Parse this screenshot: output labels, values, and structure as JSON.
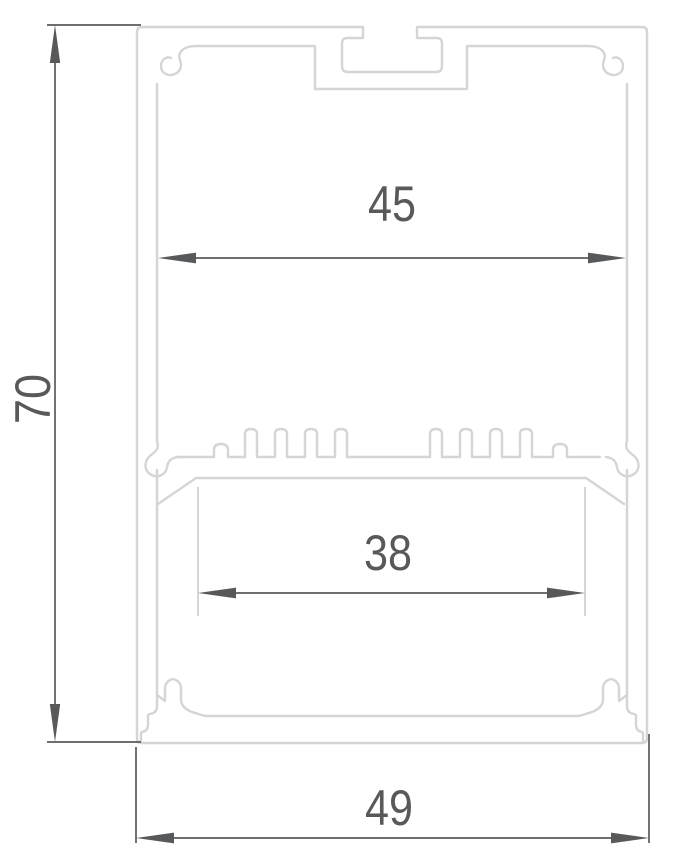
{
  "drawing": {
    "colors": {
      "background": "#ffffff",
      "profile_outline": "#d5d5d6",
      "dimension": "#58595b"
    },
    "dimensions": {
      "overall_height": "70",
      "top_inner_width": "45",
      "lens_opening_width": "38",
      "overall_width": "49"
    }
  }
}
